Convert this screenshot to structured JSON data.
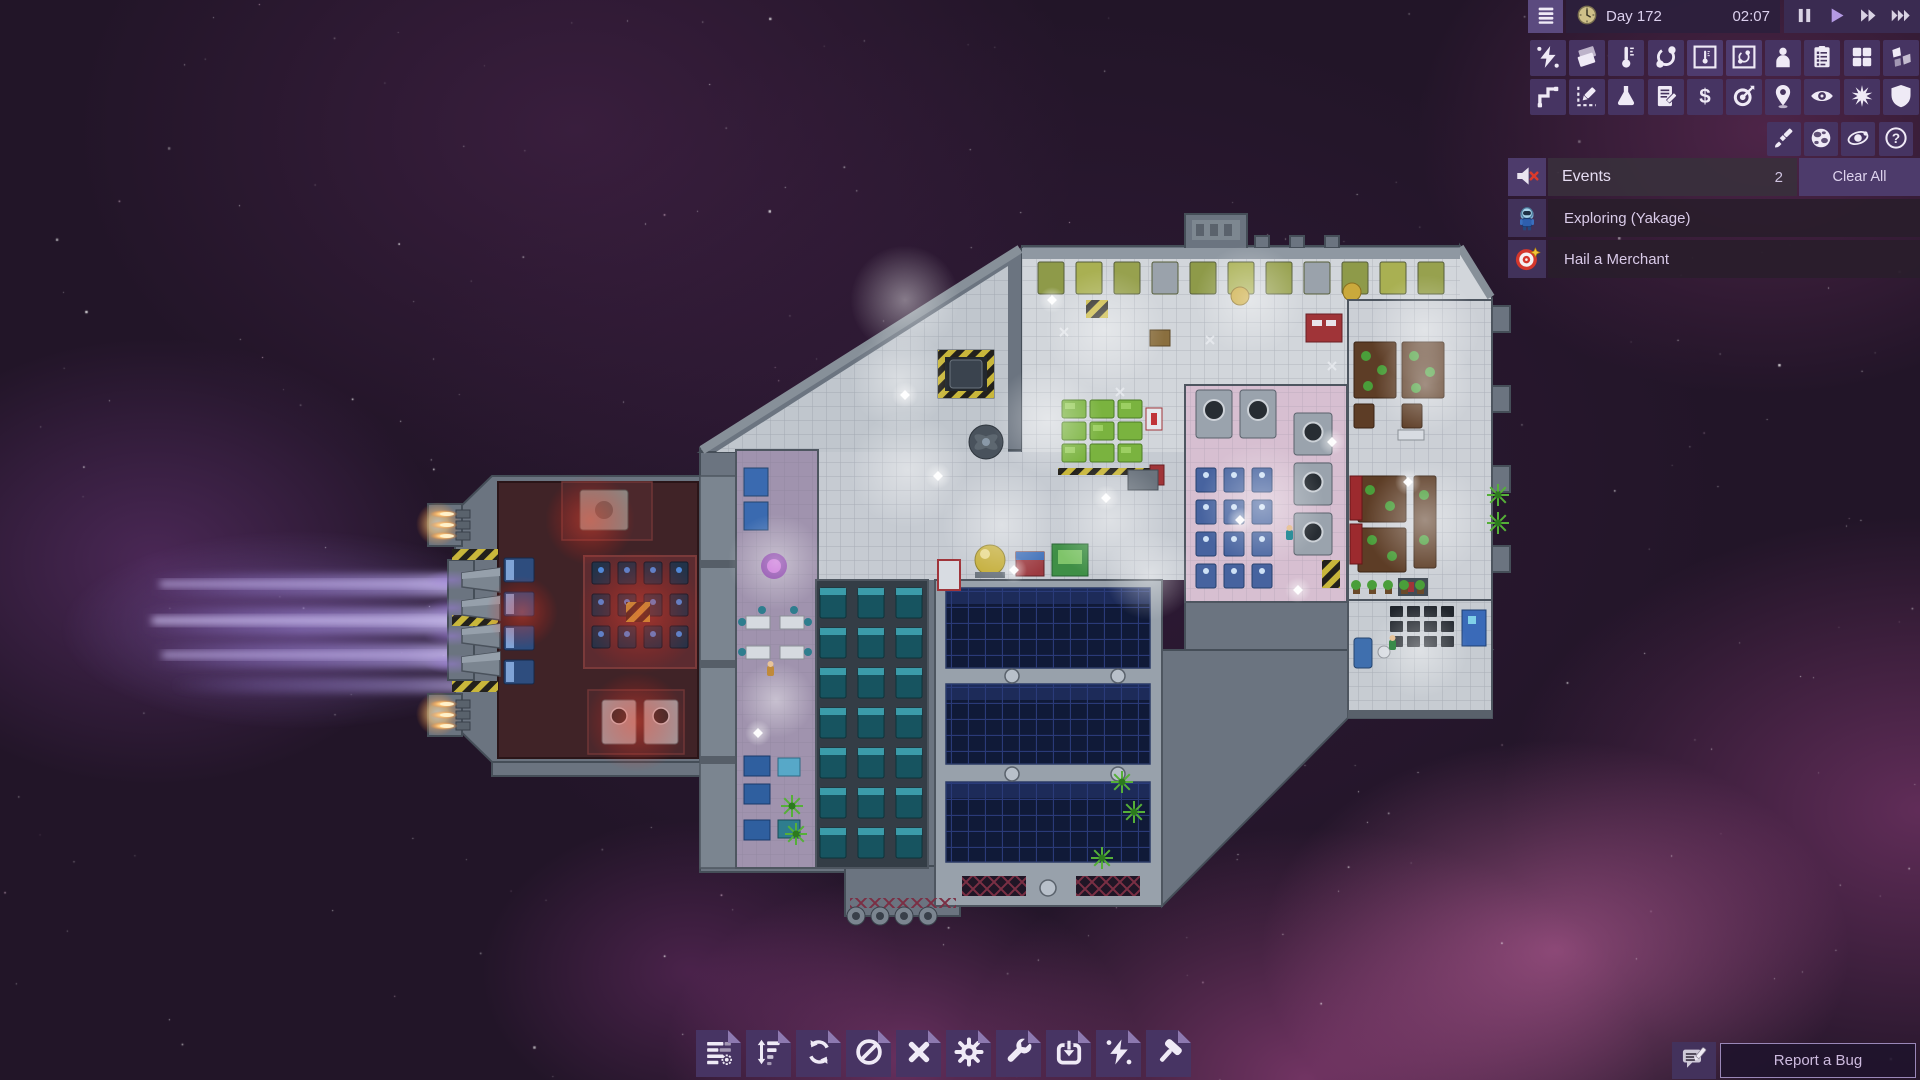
{
  "header": {
    "menu_icon": "menu-icon",
    "clock_icon": "clock-icon",
    "day_label": "Day 172",
    "time_label": "02:07",
    "playback": [
      {
        "icon": "pause-icon",
        "active": false
      },
      {
        "icon": "play-icon",
        "active": true
      },
      {
        "icon": "fast-forward-icon",
        "active": false
      },
      {
        "icon": "fastest-forward-icon",
        "active": false
      }
    ]
  },
  "overlay_toolbar": {
    "row1": [
      {
        "icon": "power-lightning-icon",
        "active": false
      },
      {
        "icon": "floor-tiles-icon",
        "active": false
      },
      {
        "icon": "thermometer-icon",
        "active": false
      },
      {
        "icon": "gas-orbit-icon",
        "active": false
      },
      {
        "icon": "thermometer-overlay-icon",
        "active": true
      },
      {
        "icon": "gas-overlay-icon",
        "active": true
      },
      {
        "icon": "crew-icon",
        "active": false
      },
      {
        "icon": "task-list-icon",
        "active": false
      },
      {
        "icon": "rooms-grid-icon",
        "active": false
      },
      {
        "icon": "hull-breach-icon",
        "active": false
      }
    ],
    "row2": [
      {
        "icon": "pipes-network-icon",
        "active": false
      },
      {
        "icon": "draft-plan-icon",
        "active": false
      },
      {
        "icon": "research-flask-icon",
        "active": false
      },
      {
        "icon": "data-log-icon",
        "active": false
      },
      {
        "icon": "trade-dollar-icon",
        "active": false
      },
      {
        "icon": "missions-target-icon",
        "active": false
      },
      {
        "icon": "travel-pin-icon",
        "active": false
      },
      {
        "icon": "view-eye-icon",
        "active": false
      },
      {
        "icon": "combat-burst-icon",
        "active": false
      },
      {
        "icon": "shield-icon",
        "active": false
      }
    ],
    "row3": [
      {
        "icon": "paint-brush-icon",
        "active": false
      },
      {
        "icon": "planet-icon",
        "active": false
      },
      {
        "icon": "star-system-icon",
        "active": false
      },
      {
        "icon": "help-icon",
        "active": false
      }
    ]
  },
  "events": {
    "mute_icon": "muted-speaker-icon",
    "title": "Events",
    "count": "2",
    "clear_all_label": "Clear All",
    "items": [
      {
        "icon": "astronaut-icon",
        "label": "Exploring (Yakage)"
      },
      {
        "icon": "merchant-target-icon",
        "label": "Hail a Merchant"
      }
    ]
  },
  "bottom_toolbar": {
    "buttons": [
      {
        "icon": "manage-list-icon"
      },
      {
        "icon": "priority-sort-icon"
      },
      {
        "icon": "rotate-cycle-icon"
      },
      {
        "icon": "forbid-icon"
      },
      {
        "icon": "deconstruct-x-icon"
      },
      {
        "icon": "operations-gear-icon"
      },
      {
        "icon": "repair-wrench-icon"
      },
      {
        "icon": "salvage-import-icon"
      },
      {
        "icon": "power-bolt-icon"
      },
      {
        "icon": "build-hammer-icon"
      }
    ]
  },
  "report_bug": {
    "icon": "message-pencil-icon",
    "label": "Report a Bug"
  },
  "colors": {
    "button_purple": "#463462",
    "panel_purple": "#4d3b6b",
    "event_row_dark": "#2a1d2c",
    "play_accent": "#b49ae4",
    "hull_gray": "#6b7480",
    "event_text": "#d9cae8",
    "mute_x_red": "#d93a2b"
  }
}
